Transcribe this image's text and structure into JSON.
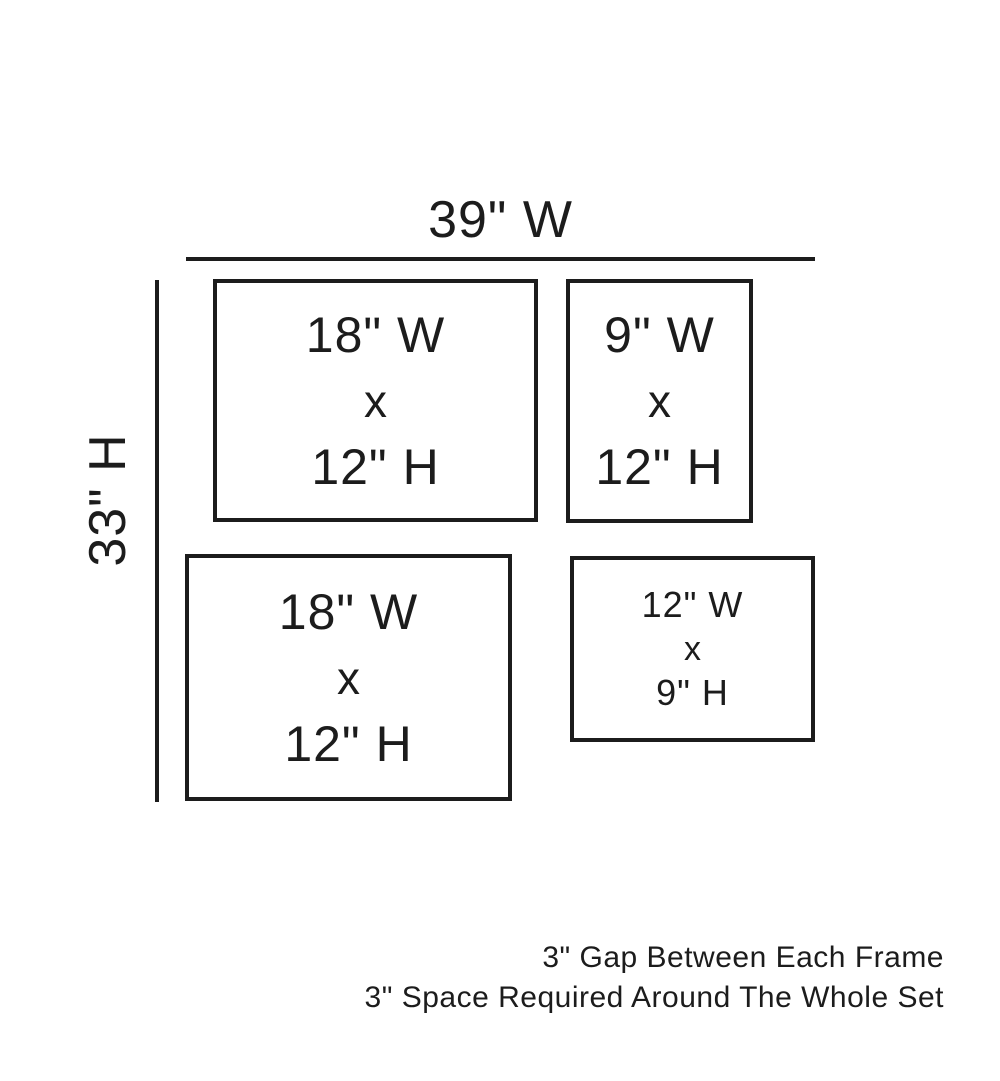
{
  "page": {
    "background_color": "#ffffff",
    "line_color": "#1c1c1c"
  },
  "dimensions": {
    "total_width_label": "39\" W",
    "total_height_label": "33\" H"
  },
  "frames": [
    {
      "position": "top-left",
      "width_label": "18\" W",
      "times": "x",
      "height_label": "12\" H"
    },
    {
      "position": "top-right",
      "width_label": "9\" W",
      "times": "x",
      "height_label": "12\" H"
    },
    {
      "position": "bottom-left",
      "width_label": "18\" W",
      "times": "x",
      "height_label": "12\" H"
    },
    {
      "position": "bottom-right",
      "width_label": "12\" W",
      "times": "x",
      "height_label": "9\" H"
    }
  ],
  "notes": {
    "line1": "3\" Gap Between Each Frame",
    "line2": "3\" Space Required Around The Whole Set"
  }
}
